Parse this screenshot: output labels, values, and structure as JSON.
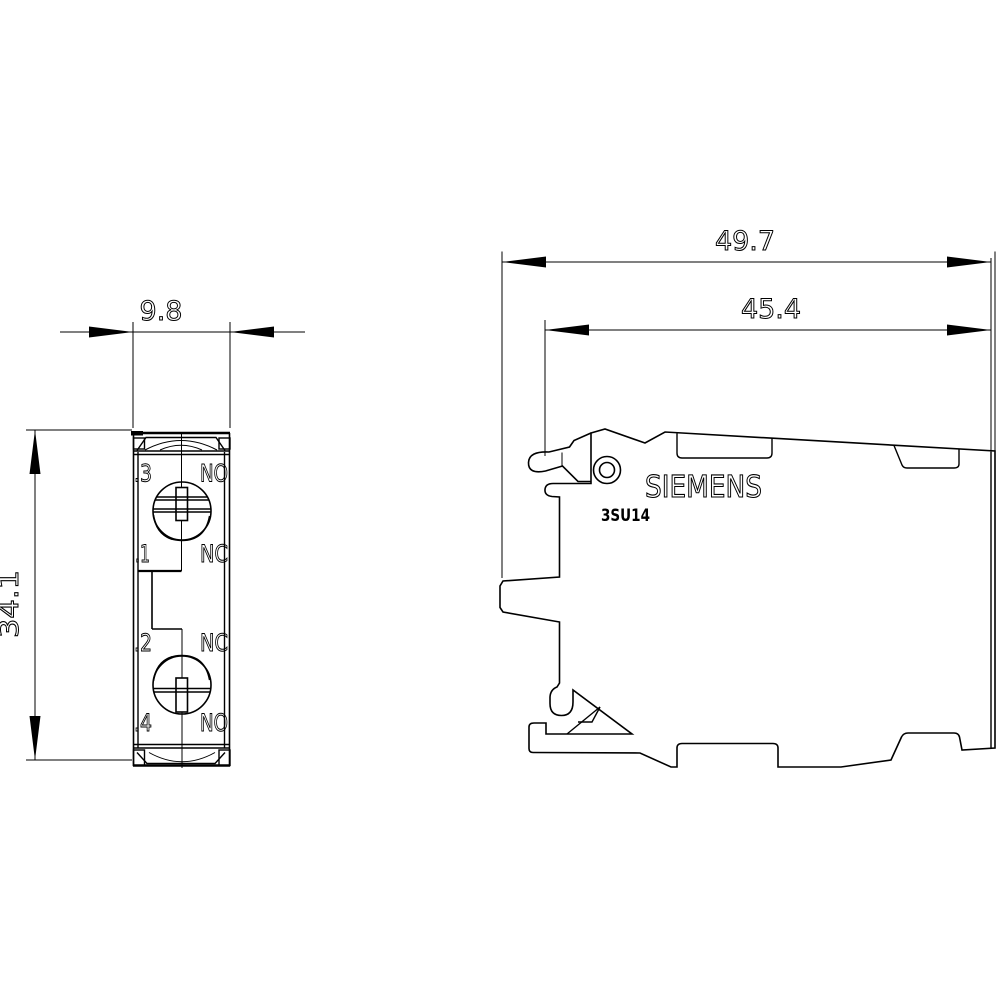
{
  "front_view": {
    "width_dim": "9.8",
    "height_dim": "34.1",
    "terminals": [
      {
        "number": ".3",
        "type": "NO"
      },
      {
        "number": ".1",
        "type": "NC"
      },
      {
        "number": ".2",
        "type": "NC"
      },
      {
        "number": ".4",
        "type": "NO"
      }
    ]
  },
  "side_view": {
    "overall_width_dim": "49.7",
    "inner_width_dim": "45.4",
    "brand": "SIEMENS",
    "model": "3SU14"
  },
  "colors": {
    "line": "#000000",
    "background": "#ffffff"
  }
}
